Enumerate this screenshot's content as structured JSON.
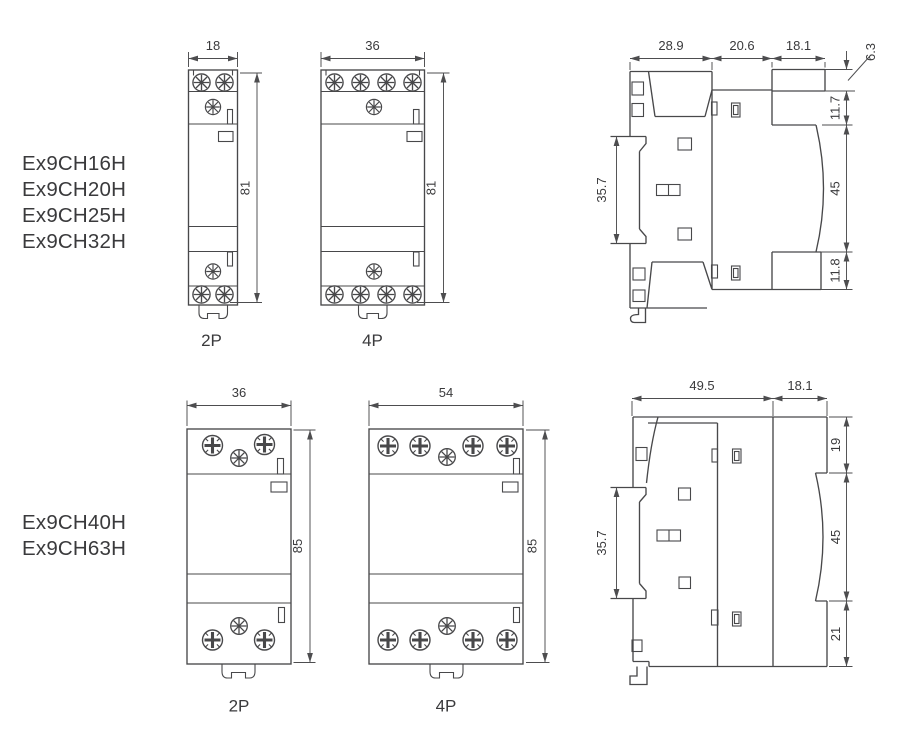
{
  "groups": [
    {
      "models": [
        "Ex9CH16H",
        "Ex9CH20H",
        "Ex9CH25H",
        "Ex9CH32H"
      ],
      "front2p": {
        "width": "18",
        "height": "81",
        "caption": "2P"
      },
      "front4p": {
        "width": "36",
        "height": "81",
        "caption": "4P"
      },
      "side": {
        "top": [
          "28.9",
          "20.6",
          "18.1"
        ],
        "right": [
          "6.3",
          "11.7",
          "45",
          "11.8"
        ],
        "left": "35.7"
      }
    },
    {
      "models": [
        "Ex9CH40H",
        "Ex9CH63H"
      ],
      "front2p": {
        "width": "36",
        "height": "85",
        "caption": "2P"
      },
      "front4p": {
        "width": "54",
        "height": "85",
        "caption": "4P"
      },
      "side": {
        "top": [
          "49.5",
          "18.1"
        ],
        "right": [
          "19",
          "45",
          "21"
        ],
        "left": "35.7"
      }
    }
  ],
  "colors": {
    "line": "#48484a",
    "text": "#3a3a3c",
    "background": "#ffffff"
  }
}
